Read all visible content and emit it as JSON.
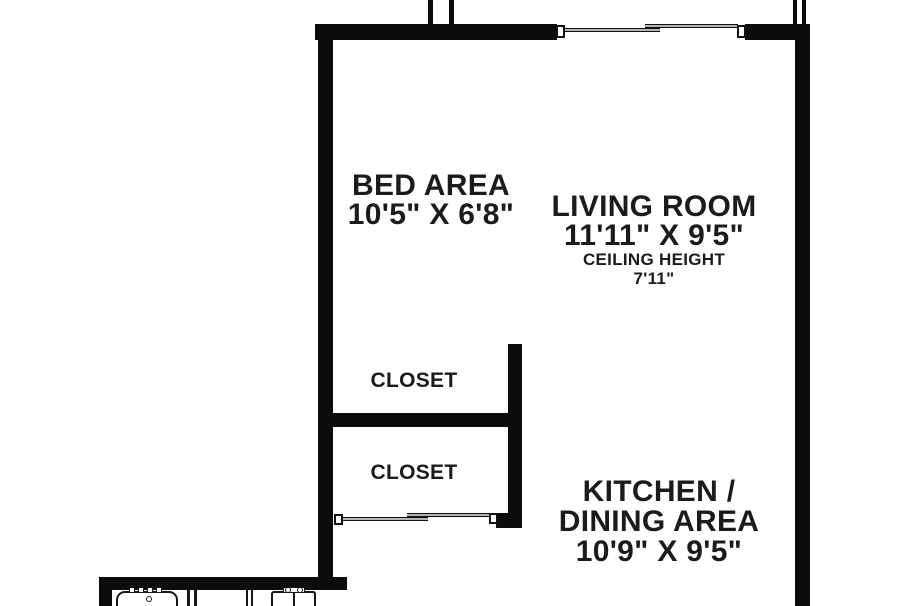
{
  "colors": {
    "wall": "#0c0c0c",
    "text": "#1b1b1b",
    "background": "#ffffff"
  },
  "rooms": {
    "bed_area": {
      "name": "BED AREA",
      "dims": "10'5\" X 6'8\""
    },
    "living_room": {
      "name": "LIVING ROOM",
      "dims": "11'11\" X 9'5\"",
      "ceiling_label": "CEILING HEIGHT",
      "ceiling_value": "7'11\""
    },
    "closet_top": {
      "name": "CLOSET"
    },
    "closet_bottom": {
      "name": "CLOSET"
    },
    "kitchen_dining": {
      "name_line1": "KITCHEN /",
      "name_line2": "DINING AREA",
      "dims": "10'9\" X 9'5\""
    }
  },
  "fixtures": {
    "window": "sliding-window",
    "closet_door": "sliding-bypass-door",
    "bath": [
      "bathtub",
      "shower-partition",
      "sink"
    ]
  }
}
